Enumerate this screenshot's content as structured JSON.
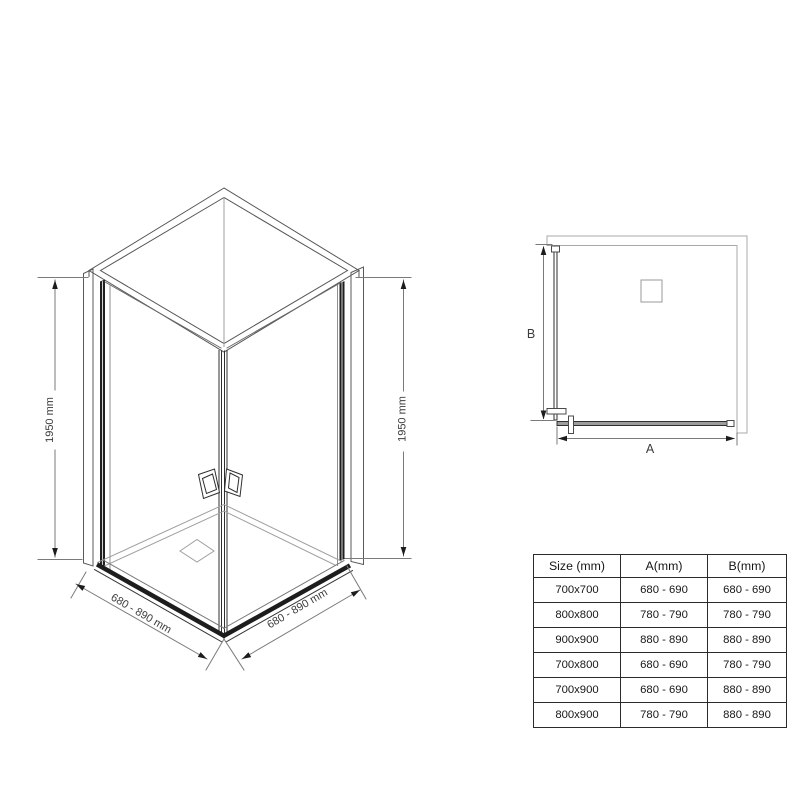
{
  "colors": {
    "background": "#ffffff",
    "drawing_line": "#4a4a4a",
    "light_line": "#a8a8a8",
    "glass_profile": "#1f1f1f",
    "glass_fill_gray": "#9c9c9c",
    "dimension_line": "#7a7a7a",
    "arrow": "#1c1c1c",
    "text": "#3c3c3c",
    "table_border": "#2b2b2b"
  },
  "iso_view": {
    "left_height_label": "1950 mm",
    "right_height_label": "1950 mm",
    "left_width_label": "680 - 890 mm",
    "right_width_label": "680 - 890 mm"
  },
  "plan_view": {
    "width_label": "A",
    "depth_label": "B"
  },
  "size_table": {
    "headers": [
      "Size (mm)",
      "A(mm)",
      "B(mm)"
    ],
    "rows": [
      [
        "700x700",
        "680 - 690",
        "680 - 690"
      ],
      [
        "800x800",
        "780 - 790",
        "780 - 790"
      ],
      [
        "900x900",
        "880 - 890",
        "880 - 890"
      ],
      [
        "700x800",
        "680 - 690",
        "780 - 790"
      ],
      [
        "700x900",
        "680 - 690",
        "880 - 890"
      ],
      [
        "800x900",
        "780 - 790",
        "880 - 890"
      ]
    ]
  }
}
